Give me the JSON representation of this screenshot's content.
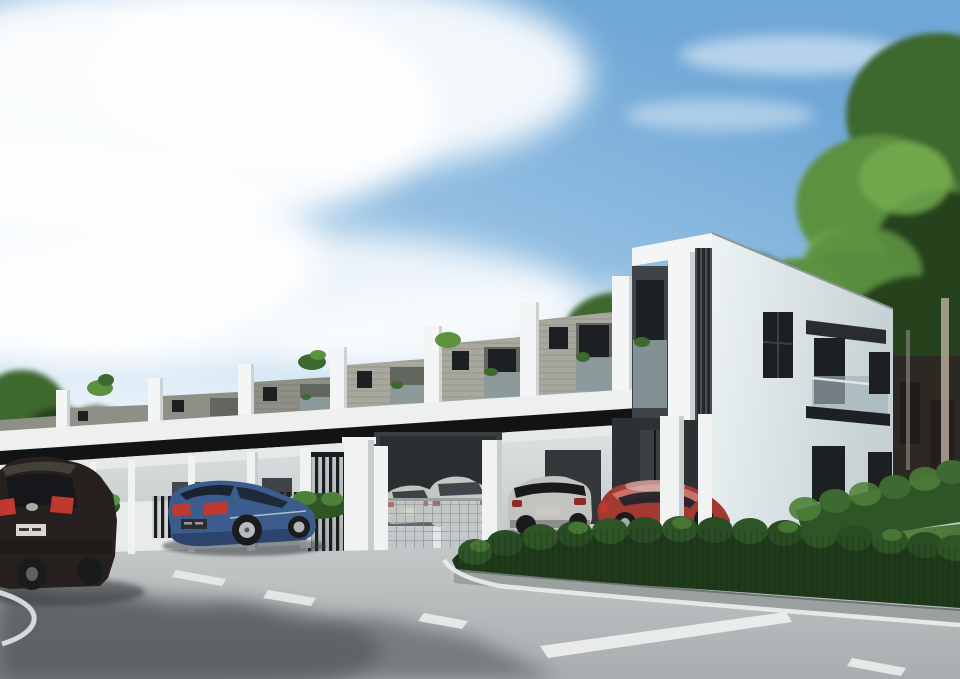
{
  "scene": {
    "type": "architectural-exterior-rendering",
    "setting": "Modern two-storey terraced houses with long black carport canopy, white columns, parked cars, trimmed hedges, lawn corner and asphalt road under a partly cloudy blue sky",
    "time_of_day": "day",
    "terrace_units_visible": 8,
    "cars": [
      {
        "name": "dark-suv",
        "color_ref": "carKia",
        "position": "far left, rear view, cropped by frame"
      },
      {
        "name": "blue-sedan",
        "color_ref": "carBlue",
        "position": "left of center, rear three-quarter view"
      },
      {
        "name": "silver-sedan-carport",
        "color_ref": "carSilver",
        "position": "center, inside carport behind mesh fence"
      },
      {
        "name": "silver-suv-carport",
        "color_ref": "carSilver",
        "position": "center, inside carport behind mesh fence"
      },
      {
        "name": "silver-suv",
        "color_ref": "carSilver",
        "position": "center right, rear view in front of end unit"
      },
      {
        "name": "red-coupe",
        "color_ref": "carRed",
        "position": "right, side view under end-unit porch"
      }
    ],
    "landscape": [
      "trees-left",
      "trees-right",
      "trees-behind-roofline",
      "roof-plants",
      "shrubs",
      "hedge-outer",
      "hedge-inner",
      "lawn"
    ],
    "road": {
      "surface": "asphalt",
      "markings": [
        "dashed-centre-line",
        "thick-white-edge-line",
        "corner-curve-line",
        "kerb-edge-line"
      ],
      "shadows": "tree shadows across lower left of road"
    },
    "background": [
      "dark building behind trees at far right",
      "tree trunks"
    ]
  },
  "colors": {
    "skyTop": "#6fa7d6",
    "skyMid": "#a9cde9",
    "skyHorizon": "#eaf2f8",
    "cloud": "#ffffff",
    "treeDark": "#27431f",
    "treeMid": "#3d682f",
    "treeLight": "#5c9140",
    "treeBright": "#72aa4f",
    "finWhite": "#f4f6f5",
    "finShade": "#cdd3d5",
    "panelGray": "#8e8f86",
    "panelGrayLight": "#a9a89e",
    "panelDark": "#63655f",
    "windowDark": "#1d2023",
    "windowFrame": "#45484c",
    "glassBalcony": "#9fb0b5",
    "fasciaWhite": "#eef0ef",
    "canopyBlack": "#111314",
    "soffitWhite": "#e6e9e8",
    "groundWallTop": "#dde1e1",
    "groundWallBot": "#bfc5c7",
    "interiorDark": "#33373a",
    "columnWhite": "#f1f3f2",
    "columnShade": "#c7ccce",
    "fenceDark": "#1b1e20",
    "lowWallWhite": "#e9ebea",
    "endWallLight": "#edf3f4",
    "endWallShade": "#c6d1d4",
    "louverDark": "#23262a",
    "bgBuilding": "#2c2824",
    "trunkLight": "#b3a896",
    "hedgeDark": "#1f3a1b",
    "hedgeMid": "#2f5527",
    "hedgeLight": "#4d8038",
    "lawnLight": "#84b062",
    "lawnShade": "#4a7539",
    "curb": "#9aa09e",
    "curbShade": "#6f7574",
    "roadLight": "#c9cccc",
    "roadDark": "#a9adaf",
    "roadShadow": "#41474a",
    "marking": "#eceeee",
    "carKia": "#26211e",
    "carKiaLight": "#4a4540",
    "carBlue": "#3b5c8c",
    "carBlueDark": "#2b4066",
    "carSilver": "#c2c3bf",
    "carSilverDark": "#8f918e",
    "carRed": "#a23a32",
    "carRedLight": "#cf7d72",
    "tailRed": "#c0392f",
    "plateWhite": "#d8d8d0",
    "wheelDark": "#191b1d",
    "wheelHub": "#a8acad"
  }
}
